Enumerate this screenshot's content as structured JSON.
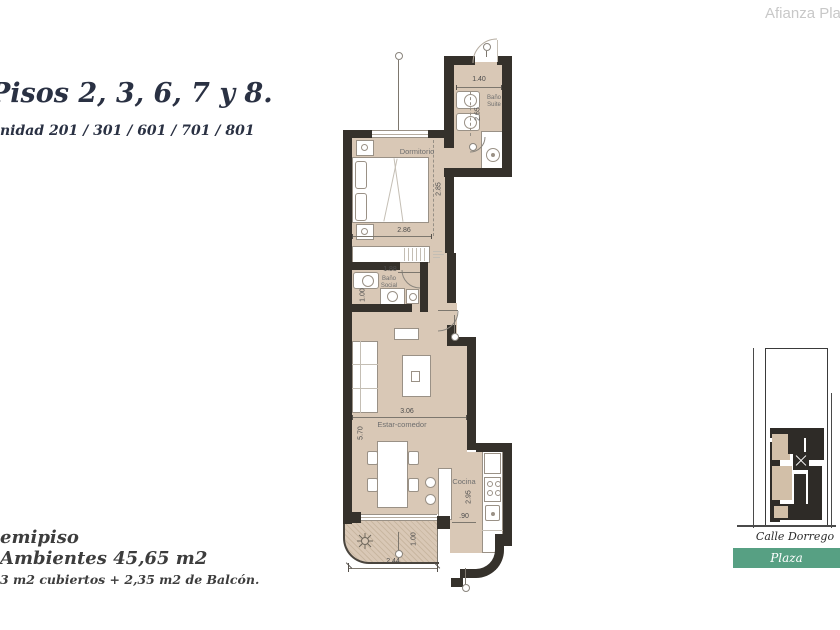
{
  "brand": "Afianza Plaza",
  "header": {
    "title": "Pisos 2, 3, 6, 7 y 8.",
    "units": "nidad 201 / 301 / 601 / 701 / 801"
  },
  "footer": {
    "type_line": "emipiso",
    "area_line": "Ambientes 45,65 m2",
    "detail_line": "3 m2 cubiertos + 2,35 m2 de Balcón."
  },
  "plan": {
    "rooms": {
      "dormitorio": "Dormitorio",
      "bano_suite_line1": "Baño",
      "bano_suite_line2": "Suite",
      "bano_social_line1": "Baño",
      "bano_social_line2": "Social",
      "estar_comedor": "Estar-comedor",
      "cocina": "Cocina"
    },
    "dimensions": {
      "suite_width": "1.40",
      "suite_depth": "2.65",
      "dorm_depth": "2.85",
      "dorm_width": "2.86",
      "bano_social_width": "1.88",
      "bano_social_depth": "1.00",
      "estar_width": "3.06",
      "estar_depth": "5.70",
      "cocina_depth": "2.95",
      "cocina_pass": ".90",
      "balcon_depth": "1.00",
      "balcon_width": "2.44"
    }
  },
  "map": {
    "street": "Calle Dorrego",
    "plaza_label": "Plaza"
  },
  "colors": {
    "wall": "#35312b",
    "floor": "#d9c8b6",
    "accent_green": "#57a083",
    "title_navy": "#2a3143",
    "brand_gray": "#c8c8c8"
  }
}
